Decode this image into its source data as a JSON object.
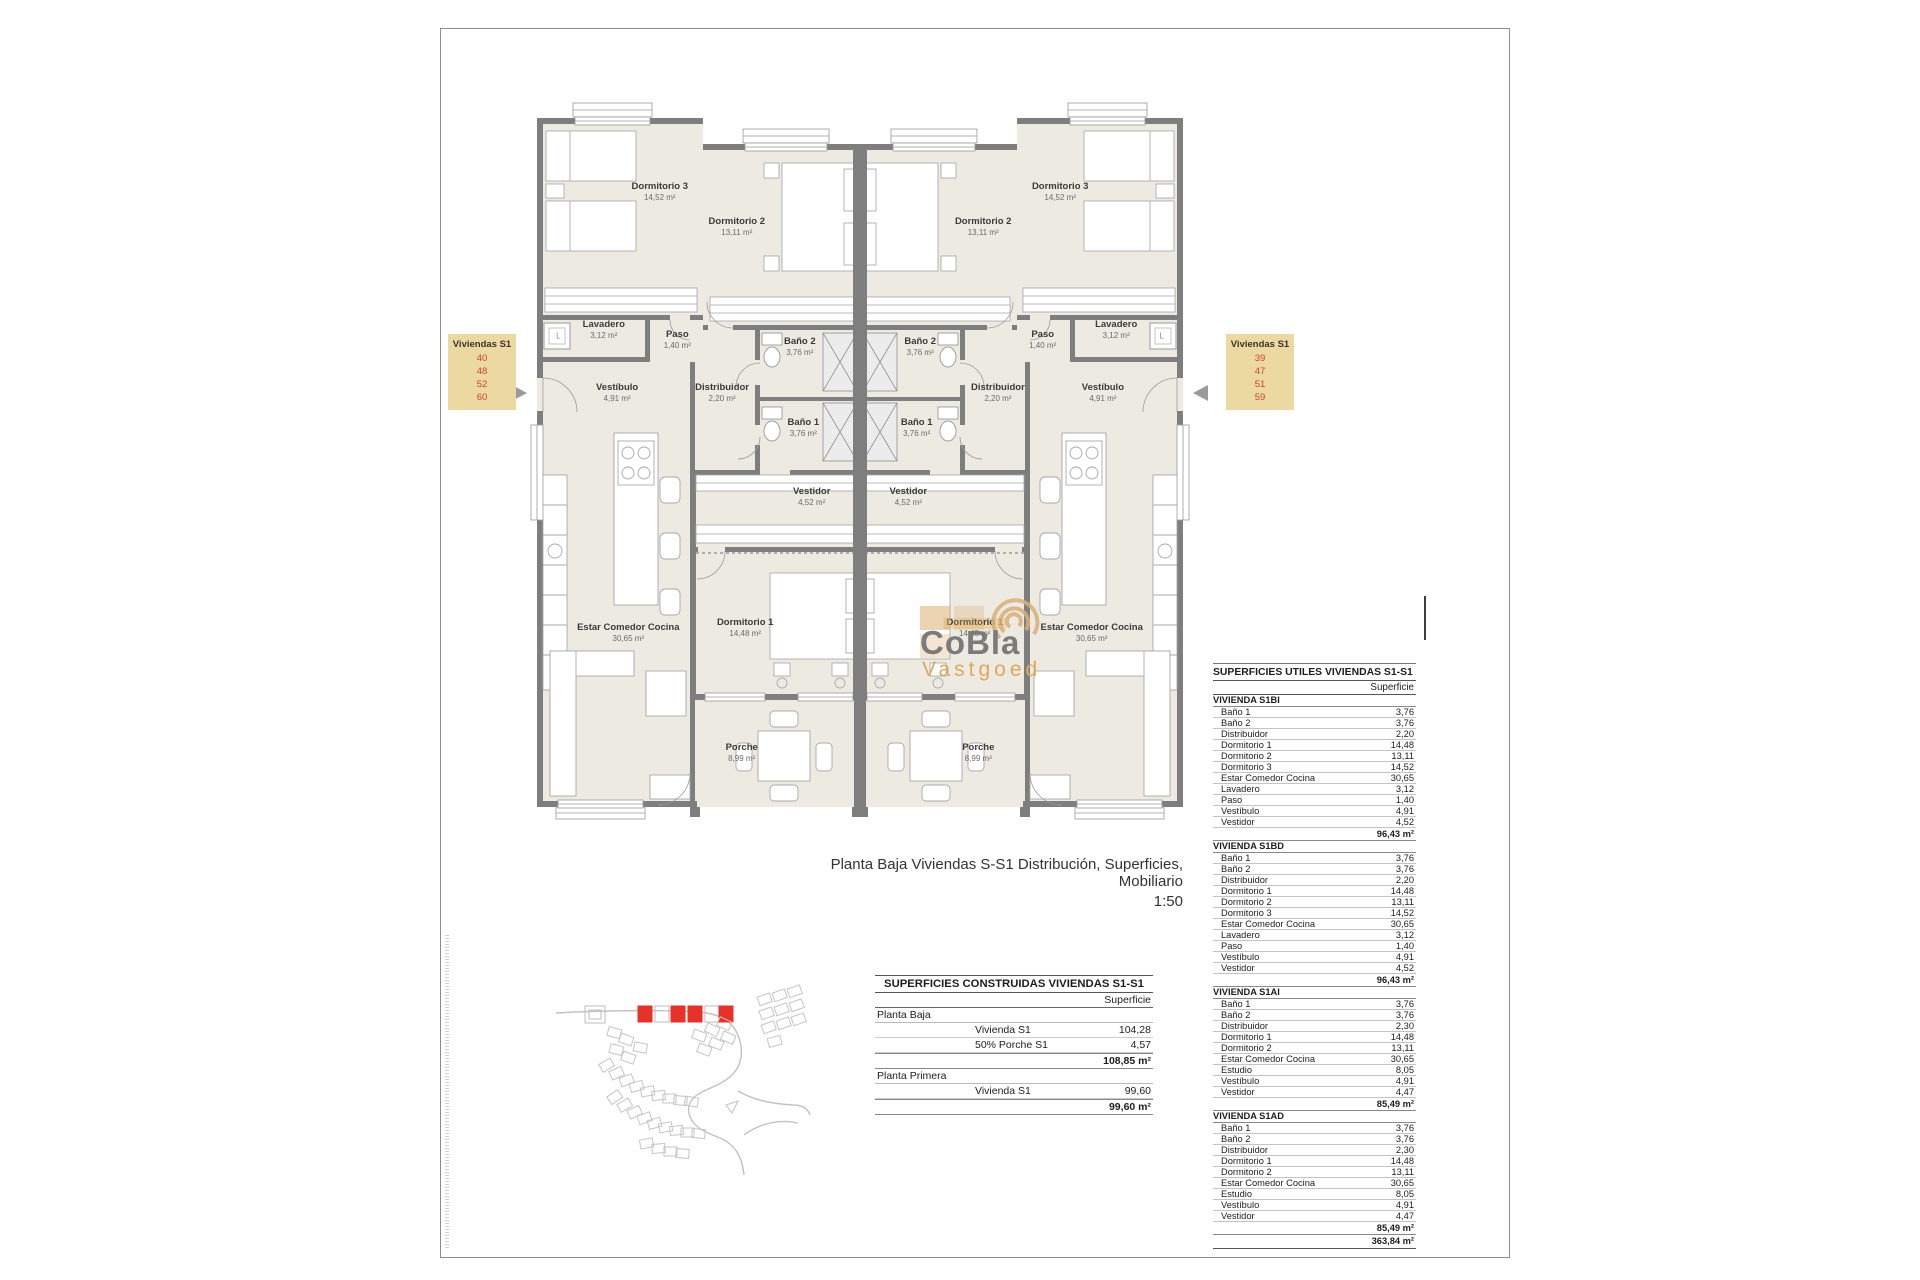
{
  "plan": {
    "caption_line1": "Planta Baja Viviendas S-S1 Distribución, Superficies, Mobiliario",
    "caption_line2": "1:50",
    "lavadero_letter": "L",
    "tags": {
      "left": {
        "title": "Viviendas S1",
        "numbers": [
          "40",
          "48",
          "52",
          "60"
        ]
      },
      "right": {
        "title": "Viviendas S1",
        "numbers": [
          "39",
          "47",
          "51",
          "59"
        ]
      }
    },
    "tag_colors": {
      "box": "#ecd9a2",
      "numbers": "#cb4336"
    },
    "rooms": [
      {
        "name": "Dormitorio 3",
        "area": "14,52 m²",
        "x": 21.4,
        "y": 14.5
      },
      {
        "name": "Dormitorio 2",
        "area": "13,11 m²",
        "x": 32.4,
        "y": 19.2
      },
      {
        "name": "Lavadero",
        "area": "3,12 m²",
        "x": 13.4,
        "y": 33.1
      },
      {
        "name": "Paso",
        "area": "1,40 m²",
        "x": 23.9,
        "y": 34.5
      },
      {
        "name": "Baño 2",
        "area": "3,76 m²",
        "x": 41.4,
        "y": 35.4
      },
      {
        "name": "Vestíbulo",
        "area": "4,91 m²",
        "x": 15.3,
        "y": 41.6
      },
      {
        "name": "Distribuidor",
        "area": "2,20 m²",
        "x": 30.3,
        "y": 41.6
      },
      {
        "name": "Baño 1",
        "area": "3,76 m²",
        "x": 41.9,
        "y": 46.4
      },
      {
        "name": "Vestidor",
        "area": "4,52 m²",
        "x": 43.1,
        "y": 55.7
      },
      {
        "name": "Estar Comedor Cocina",
        "area": "30,65 m²",
        "x": 16.9,
        "y": 74.1
      },
      {
        "name": "Dormitorio 1",
        "area": "14,48 m²",
        "x": 33.6,
        "y": 73.4
      },
      {
        "name": "Porche",
        "area": "8,99 m²",
        "x": 33.1,
        "y": 90.3
      },
      {
        "name": "Dormitorio 3",
        "area": "14,52 m²",
        "x": 78.6,
        "y": 14.5
      },
      {
        "name": "Dormitorio 2",
        "area": "13,11 m²",
        "x": 67.6,
        "y": 19.2
      },
      {
        "name": "Lavadero",
        "area": "3,12 m²",
        "x": 86.6,
        "y": 33.1
      },
      {
        "name": "Paso",
        "area": "1,40 m²",
        "x": 76.1,
        "y": 34.5
      },
      {
        "name": "Baño 2",
        "area": "3,76 m²",
        "x": 58.6,
        "y": 35.4
      },
      {
        "name": "Vestíbulo",
        "area": "4,91 m²",
        "x": 84.7,
        "y": 41.6
      },
      {
        "name": "Distribuidor",
        "area": "2,20 m²",
        "x": 69.7,
        "y": 41.6
      },
      {
        "name": "Baño 1",
        "area": "3,76 m²",
        "x": 58.1,
        "y": 46.4
      },
      {
        "name": "Vestidor",
        "area": "4,52 m²",
        "x": 56.9,
        "y": 55.7
      },
      {
        "name": "Estar Comedor Cocina",
        "area": "30,65 m²",
        "x": 83.1,
        "y": 74.1
      },
      {
        "name": "Dormitorio 1",
        "area": "14,48 m²",
        "x": 66.4,
        "y": 73.4,
        "hl": true
      },
      {
        "name": "Porche",
        "area": "8,99 m²",
        "x": 66.9,
        "y": 90.3
      }
    ]
  },
  "logo": {
    "line1": "CoBla",
    "line2": "Vastgoed"
  },
  "site_map": {
    "highlight_color": "#e63229"
  },
  "tables": {
    "construidas": {
      "title": "SUPERFICIES CONSTRUIDAS VIVIENDAS S1-S1",
      "col_header": "Superficie",
      "groups": [
        {
          "header": "Planta Baja",
          "rows": [
            [
              "Vivienda S1",
              "104,28"
            ],
            [
              "50% Porche S1",
              "4,57"
            ]
          ],
          "total": "108,85 m²"
        },
        {
          "header": "Planta Primera",
          "rows": [
            [
              "Vivienda S1",
              "99,60"
            ]
          ],
          "total": "99,60 m²"
        }
      ]
    },
    "utiles": {
      "title": "SUPERFICIES UTILES VIVIENDAS S1-S1",
      "col_header": "Superficie",
      "sections": [
        {
          "header": "VIVIENDA S1BI",
          "rows": [
            [
              "Baño 1",
              "3,76"
            ],
            [
              "Baño 2",
              "3,76"
            ],
            [
              "Distribuidor",
              "2,20"
            ],
            [
              "Dormitorio 1",
              "14,48"
            ],
            [
              "Dormitorio 2",
              "13,11"
            ],
            [
              "Dormitorio 3",
              "14,52"
            ],
            [
              "Estar Comedor Cocina",
              "30,65"
            ],
            [
              "Lavadero",
              "3,12"
            ],
            [
              "Paso",
              "1,40"
            ],
            [
              "Vestíbulo",
              "4,91"
            ],
            [
              "Vestidor",
              "4,52"
            ]
          ],
          "total": "96,43 m²"
        },
        {
          "header": "VIVIENDA S1BD",
          "rows": [
            [
              "Baño 1",
              "3,76"
            ],
            [
              "Baño 2",
              "3,76"
            ],
            [
              "Distribuidor",
              "2,20"
            ],
            [
              "Dormitorio 1",
              "14,48"
            ],
            [
              "Dormitorio 2",
              "13,11"
            ],
            [
              "Dormitorio 3",
              "14,52"
            ],
            [
              "Estar Comedor Cocina",
              "30,65"
            ],
            [
              "Lavadero",
              "3,12"
            ],
            [
              "Paso",
              "1,40"
            ],
            [
              "Vestíbulo",
              "4,91"
            ],
            [
              "Vestidor",
              "4,52"
            ]
          ],
          "total": "96,43 m²"
        },
        {
          "header": "VIVIENDA S1AI",
          "rows": [
            [
              "Baño 1",
              "3,76"
            ],
            [
              "Baño 2",
              "3,76"
            ],
            [
              "Distribuidor",
              "2,30"
            ],
            [
              "Dormitorio 1",
              "14,48"
            ],
            [
              "Dormitorio 2",
              "13,11"
            ],
            [
              "Estar Comedor Cocina",
              "30,65"
            ],
            [
              "Estudio",
              "8,05"
            ],
            [
              "Vestíbulo",
              "4,91"
            ],
            [
              "Vestidor",
              "4,47"
            ]
          ],
          "total": "85,49 m²"
        },
        {
          "header": "VIVIENDA S1AD",
          "rows": [
            [
              "Baño 1",
              "3,76"
            ],
            [
              "Baño 2",
              "3,76"
            ],
            [
              "Distribuidor",
              "2,30"
            ],
            [
              "Dormitorio 1",
              "14,48"
            ],
            [
              "Dormitorio 2",
              "13,11"
            ],
            [
              "Estar Comedor Cocina",
              "30,65"
            ],
            [
              "Estudio",
              "8,05"
            ],
            [
              "Vestíbulo",
              "4,91"
            ],
            [
              "Vestidor",
              "4,47"
            ]
          ],
          "total": "85,49 m²"
        }
      ],
      "grand_total": "363,84 m²"
    }
  }
}
